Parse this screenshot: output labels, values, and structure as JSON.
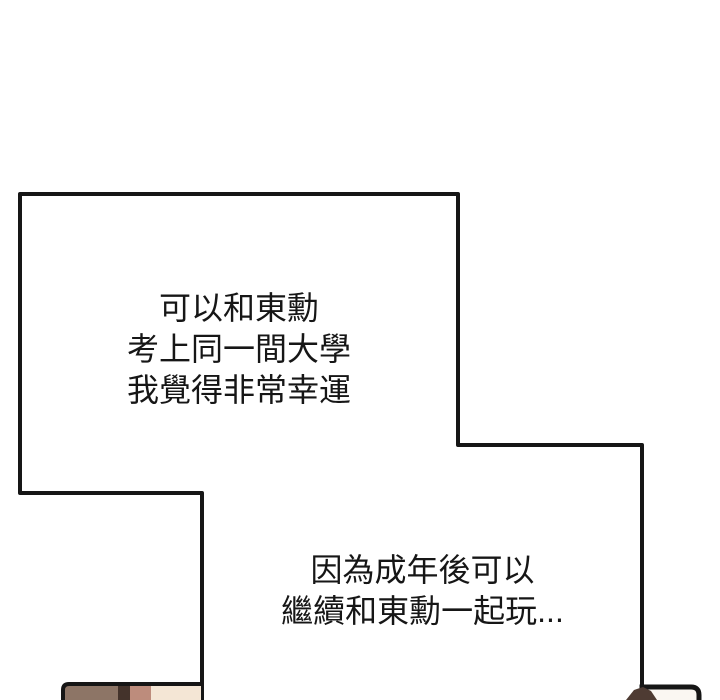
{
  "page": {
    "background": "#ffffff",
    "line_color": "#161616",
    "text_color": "#161616"
  },
  "narration_top": {
    "lines": [
      "可以和東勳",
      "考上同一間大學",
      "我覺得非常幸運"
    ]
  },
  "narration_bottom": {
    "lines": [
      "因為成年後可以",
      "繼續和東勳一起玩..."
    ]
  },
  "artwork": {
    "bottom_left": {
      "band1": "#8d7566",
      "band2": "#44332b",
      "band3": "#bd8c7c",
      "band4": "#f4e6d5"
    },
    "bottom_right": {
      "interior": "#faf7f2",
      "hair": "#4e3b33"
    }
  }
}
